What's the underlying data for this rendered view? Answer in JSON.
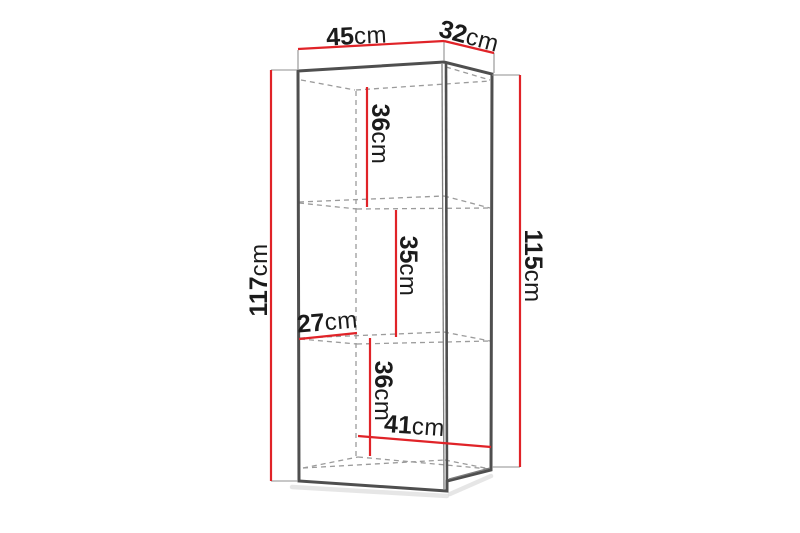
{
  "diagram": {
    "type": "furniture-dimension-drawing",
    "dimensions": {
      "width_top": {
        "value": "45",
        "unit": "cm"
      },
      "depth_top": {
        "value": "32",
        "unit": "cm"
      },
      "height_left": {
        "value": "117",
        "unit": "cm"
      },
      "height_right": {
        "value": "115",
        "unit": "cm"
      },
      "compartment_top": {
        "value": "36",
        "unit": "cm"
      },
      "compartment_mid": {
        "value": "35",
        "unit": "cm"
      },
      "compartment_bot": {
        "value": "36",
        "unit": "cm"
      },
      "depth_inner": {
        "value": "27",
        "unit": "cm"
      },
      "width_inner": {
        "value": "41",
        "unit": "cm"
      }
    },
    "colors": {
      "dimension_line": "#e02328",
      "outline": "#4f4f4f",
      "hidden_line": "#9b9b9b",
      "text": "#1b1b1b",
      "background": "#ffffff"
    }
  }
}
